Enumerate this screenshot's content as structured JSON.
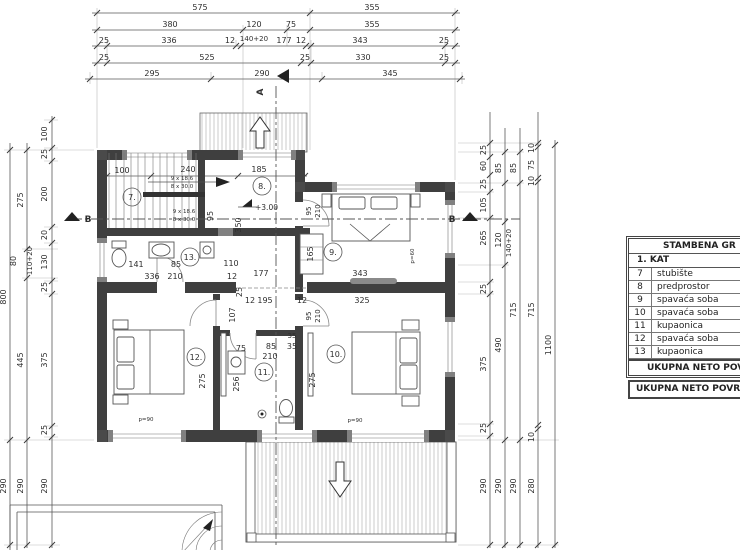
{
  "schedule": {
    "header": "STAMBENA GR",
    "floor": "1. KAT",
    "rows": [
      [
        "7",
        "stubište"
      ],
      [
        "8",
        "predprostor"
      ],
      [
        "9",
        "spavaća soba"
      ],
      [
        "10",
        "spavaća soba"
      ],
      [
        "11",
        "kupaonica"
      ],
      [
        "12",
        "spavaća soba"
      ],
      [
        "13",
        "kupaonica"
      ]
    ],
    "footer1": "UKUPNA NETO POV",
    "footer2": "UKUPNA NETO POVRŠ"
  },
  "dims": {
    "top": {
      "r1": [
        "575",
        "355"
      ],
      "r2": [
        "380",
        "120",
        "75",
        "355"
      ],
      "r3": [
        "25",
        "336",
        "12",
        "140+20",
        "177",
        "12",
        "343",
        "25"
      ],
      "r4": [
        "25",
        "525",
        "25",
        "330",
        "25"
      ],
      "r5": [
        "295",
        "290",
        "345"
      ]
    },
    "left": {
      "c1": [
        "800",
        "290"
      ],
      "c2": [
        "275",
        "80",
        "110+20",
        "445",
        "290"
      ],
      "c3": [
        "100",
        "25",
        "200",
        "20",
        "130",
        "25",
        "375",
        "25",
        "290"
      ]
    },
    "right": {
      "c1": [
        "25",
        "60",
        "25",
        "105",
        "265",
        "25",
        "375",
        "25",
        "290"
      ],
      "c2": [
        "85",
        "120",
        "140+20",
        "490",
        "290"
      ],
      "c3": [
        "85",
        "715",
        "290"
      ],
      "c4": [
        "10",
        "75",
        "10",
        "715",
        "10",
        "280"
      ],
      "c5": [
        "1100"
      ]
    }
  },
  "plan": {
    "rooms": {
      "r7": "7.",
      "r8": "8.",
      "r9": "9.",
      "r10": "10.",
      "r11": "11.",
      "r12": "12.",
      "r13": "13."
    },
    "level": "+3.00",
    "stairs": {
      "a": "9 x 18.6",
      "b": "8 x 30.0",
      "c": "9 x 18.6",
      "d": "8 x 30.0"
    },
    "sections": {
      "a": "A",
      "b_left": "B",
      "b_right": "B"
    },
    "inner": {
      "stair_w": "100",
      "stair_l": "240",
      "hall_w": "185",
      "hall_h": "350",
      "stair_clear": "95",
      "wc13_a": "141",
      "wc13_b": "85",
      "wc13_c": "110",
      "wc13_d": "336",
      "wc13_e": "210",
      "wc13_f": "12",
      "wc13_g": "25",
      "corr_a": "177",
      "corr_b": "12",
      "corr_c": "195",
      "corr_d": "12",
      "corr_e": "107",
      "r9_wr": "165",
      "r9_w": "343",
      "r9_w2": "325",
      "r9_dw": "95",
      "r9_dh": "210",
      "r10_dw": "95",
      "r10_dh": "210",
      "r10_d": "275",
      "r10_e": "35",
      "r11_a": "85",
      "r11_b": "35",
      "r11_c": "210",
      "r11_d": "75",
      "r11_e": "256",
      "r12_d": "275",
      "par1": "p=90",
      "par2": "p=90",
      "par3": "p=60"
    }
  }
}
